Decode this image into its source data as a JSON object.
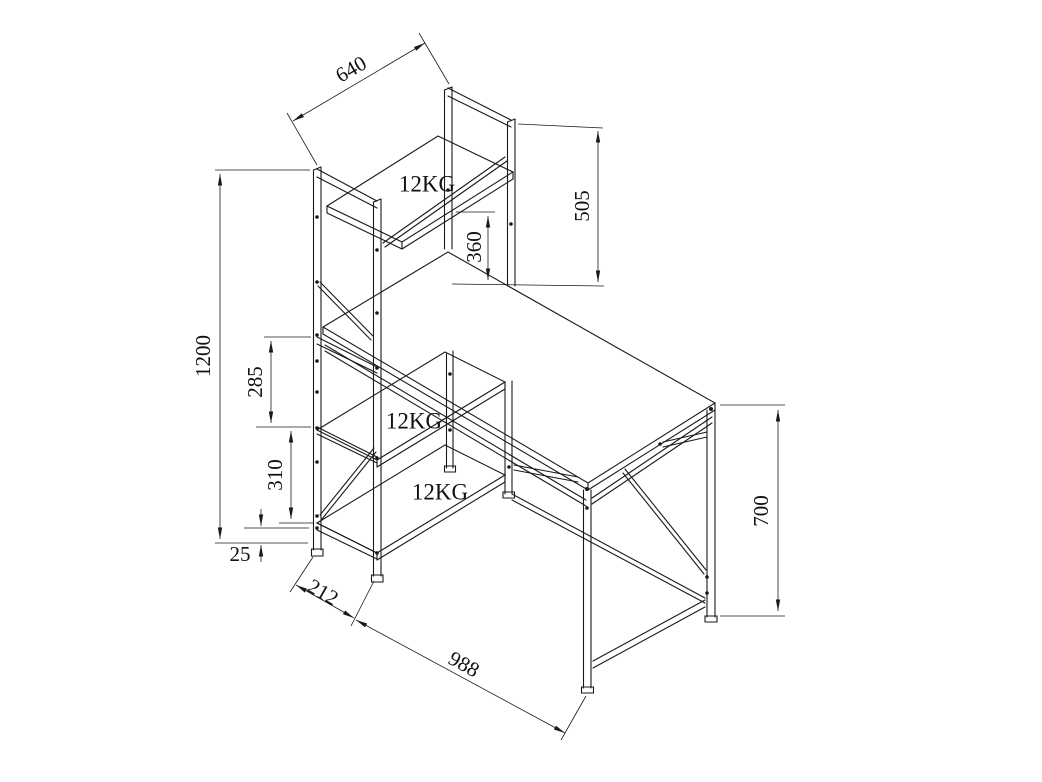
{
  "drawing": {
    "title": "desk-with-shelf-tower-technical-drawing",
    "units": "mm",
    "line_color": "#1a1a1a",
    "background_color": "#ffffff",
    "dimensions": {
      "shelf_width": "640",
      "hutch_height_above_desk": "505",
      "desk_to_top_shelf_clearance": "360",
      "total_height": "1200",
      "upper_shelf_spacing": "285",
      "lower_shelf_spacing": "310",
      "bottom_clearance": "25",
      "tower_depth": "212",
      "desk_length": "988",
      "desk_height": "700"
    },
    "load_labels": [
      "12KG",
      "12KG",
      "12KG"
    ]
  }
}
